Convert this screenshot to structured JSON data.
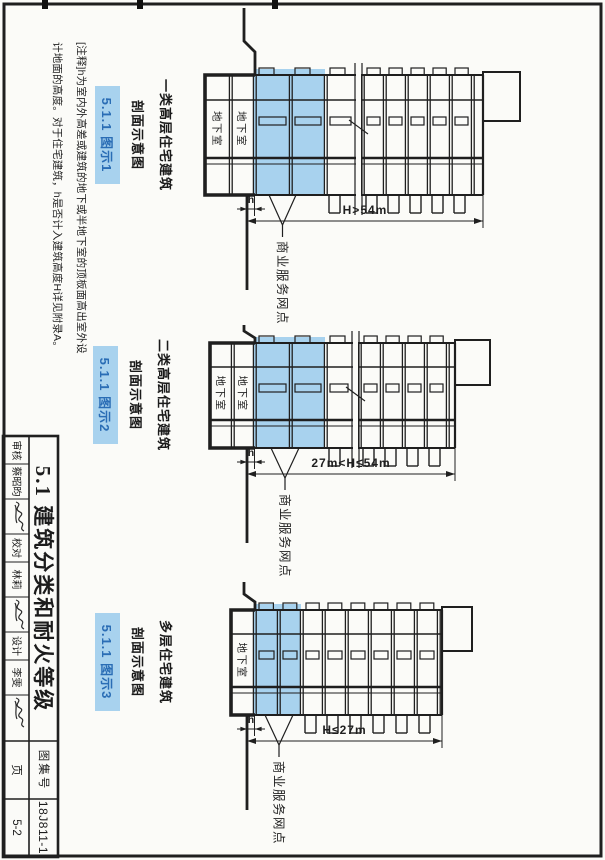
{
  "colors": {
    "highlight": "#a8d2ee",
    "tag_text": "#2a6db5",
    "ink": "#1f1f1f",
    "paper": "#fbfbf8"
  },
  "note": {
    "line1": "[注释]h为室内外高差或建筑的地下或半地下室的顶板面高出室外设",
    "line2": "计地面的高度。对于住宅建筑，h是否计入建筑高度H详见附录A。"
  },
  "title_block": {
    "title": "5.1 建筑分类和耐火等级",
    "atlas_label": "图集号",
    "atlas_no": "18J811-1",
    "page_label": "页",
    "page_no": "5-2",
    "roles": [
      {
        "label": "审核",
        "name": "蔡昭昀"
      },
      {
        "label": "校对",
        "name": "林莉"
      },
      {
        "label": "设计",
        "name": "李雯"
      }
    ]
  },
  "diagrams": [
    {
      "caption_line1": "一类高层住宅建筑",
      "caption_line2": "剖面示意图",
      "tag": "5.1.1 图示1",
      "height_dim": "H>54m",
      "h_label": "h",
      "basement_label": "地下室",
      "leader_label": "商业服务网点"
    },
    {
      "caption_line1": "二类高层住宅建筑",
      "caption_line2": "剖面示意图",
      "tag": "5.1.1 图示2",
      "height_dim": "27m<H≤54m",
      "h_label": "h",
      "basement_label": "地下室",
      "leader_label": "商业服务网点"
    },
    {
      "caption_line1": "多层住宅建筑",
      "caption_line2": "剖面示意图",
      "tag": "5.1.1 图示3",
      "height_dim": "H≤27m",
      "h_label": "h",
      "basement_label": "地下室",
      "leader_label": "商业服务网点"
    }
  ]
}
